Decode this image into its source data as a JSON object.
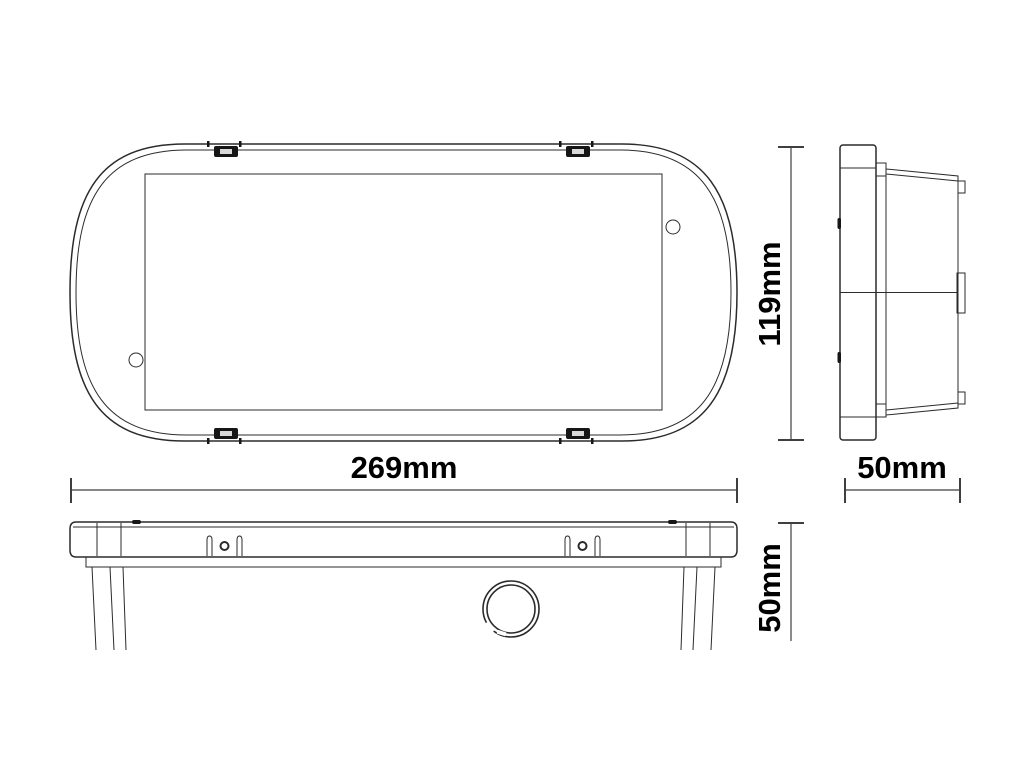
{
  "drawing": {
    "kind": "technical-dimension-drawing",
    "views": {
      "front": {
        "name": "front-view"
      },
      "side": {
        "name": "side-view"
      },
      "profile": {
        "name": "profile-view"
      }
    },
    "dimensions": {
      "front_width": "269mm",
      "front_height": "119mm",
      "side_depth": "50mm",
      "profile_height": "50mm"
    },
    "colors": {
      "line": "#2b2b2b",
      "dimension_line": "#3f3f3f",
      "text": "#000000",
      "background": "#ffffff"
    }
  }
}
